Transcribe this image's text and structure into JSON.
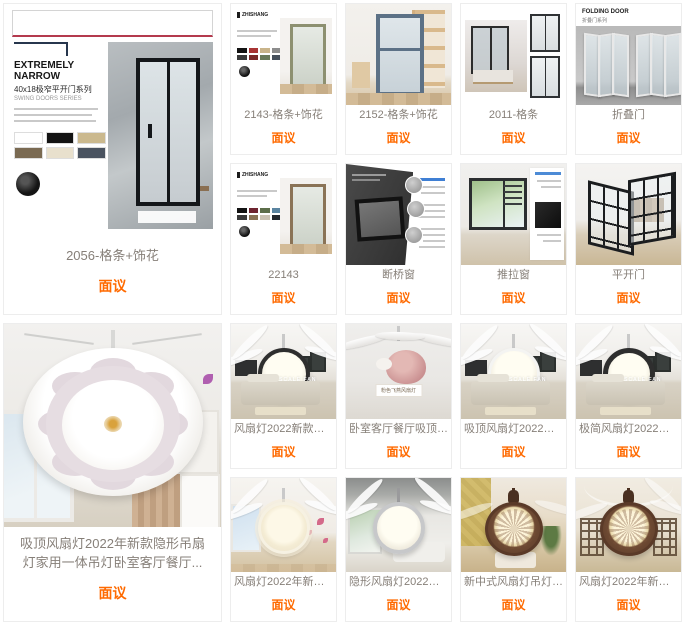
{
  "page": {
    "price_color": "#ff6a00",
    "title_color": "#867f78"
  },
  "doors": {
    "featured": {
      "title": "2056-格条+饰花",
      "price": "面议",
      "poster": {
        "heading": "EXTREMELY NARROW",
        "subheading": "40x18极窄平开门系列",
        "series": "SWING DOORS SERIES"
      }
    },
    "items": [
      {
        "title": "2143-格条+饰花",
        "price": "面议",
        "brand": "ZHISHANG"
      },
      {
        "title": "2152-格条+饰花",
        "price": "面议"
      },
      {
        "title": "2011-格条",
        "price": "面议"
      },
      {
        "title": "折叠门",
        "price": "面议",
        "poster_heading": "FOLDING DOOR",
        "poster_sub": "折叠门系列"
      },
      {
        "title": "22143",
        "price": "面议",
        "brand": "ZHISHANG"
      },
      {
        "title": "断桥窗",
        "price": "面议"
      },
      {
        "title": "推拉窗",
        "price": "面议"
      },
      {
        "title": "平开门",
        "price": "面议"
      }
    ]
  },
  "fans": {
    "featured": {
      "title_line1": "吸顶风扇灯2022年新款隐形吊扇",
      "title_line2": "灯家用一体吊灯卧室客厅餐厅...",
      "price": "面议"
    },
    "items": [
      {
        "title": "风扇灯2022新款约家用吸...",
        "price": "面议",
        "watermark": "BEST UPSCALE FAN"
      },
      {
        "title": "卧室客厅餐厅吸顶风扇灯..",
        "price": "面议",
        "caption": "粉色飞燕风扇灯"
      },
      {
        "title": "吸顶风扇灯2022年新款隐...",
        "price": "面议",
        "watermark": "BEST UPSCALE FAN"
      },
      {
        "title": "极简风扇灯2022年新款简...",
        "price": "面议",
        "watermark": "BEST UPSCALE FAN"
      },
      {
        "title": "风扇灯2022年新款客厅卧...",
        "price": "面议"
      },
      {
        "title": "隐形风扇灯2022新款简约...",
        "price": "面议"
      },
      {
        "title": "新中式风扇灯吊灯客厅灯...",
        "price": "面议"
      },
      {
        "title": "风扇灯2022年新款吸顶吊...",
        "price": "面议"
      }
    ]
  }
}
